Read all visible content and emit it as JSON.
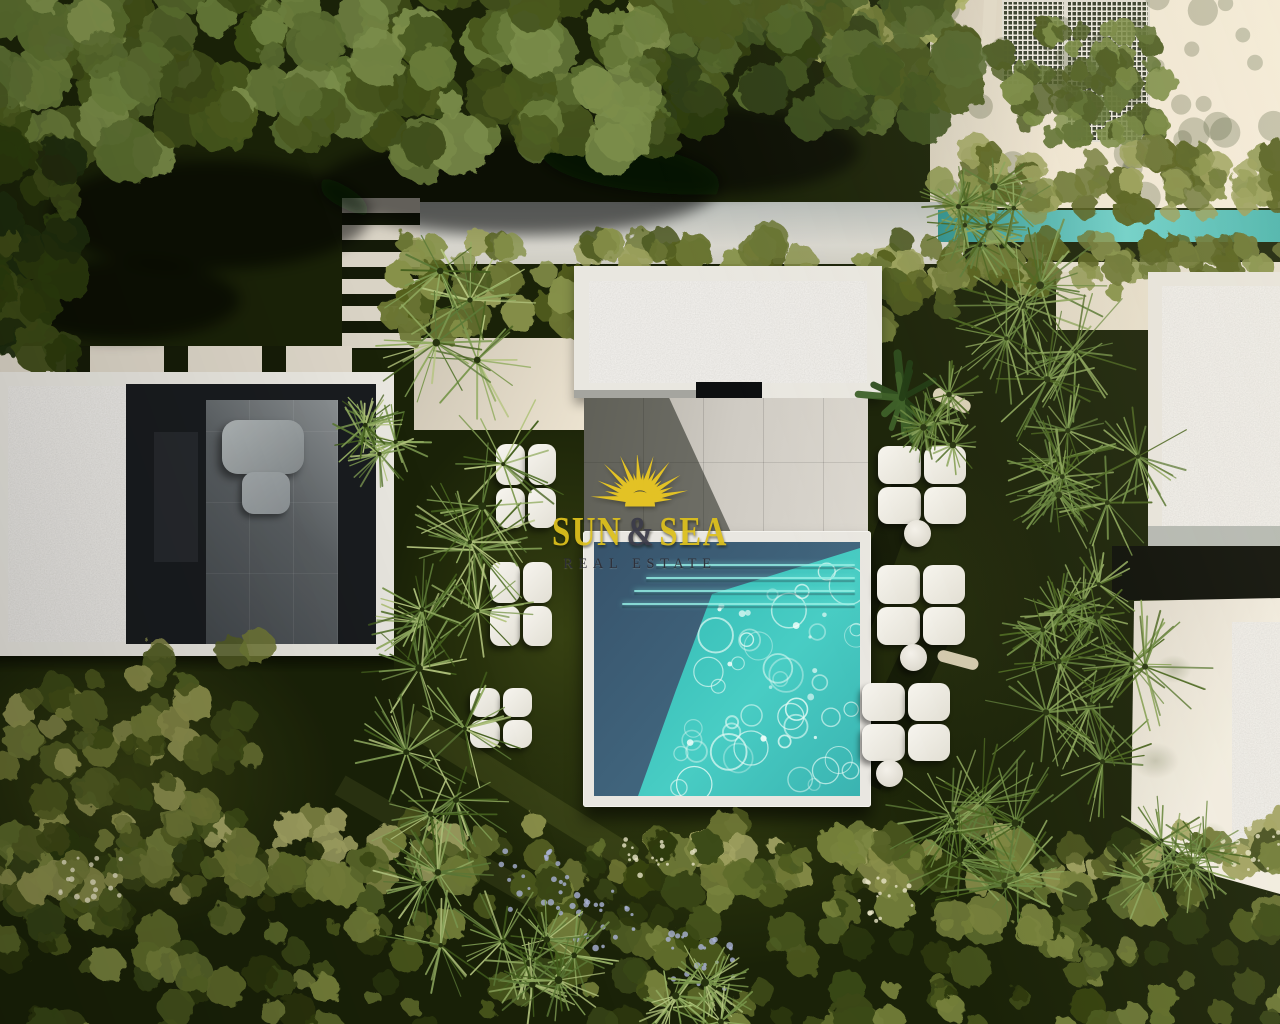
{
  "watermark": {
    "brand": {
      "word1": "SUN",
      "ampersand": "&",
      "word2": "SEA"
    },
    "tagline": "REAL ESTATE",
    "icon": "sun-icon",
    "colors": {
      "brand_text": "#dcbf1d",
      "ampersand": "#3c3c48",
      "tagline": "#2e2e36",
      "sun": "#eac822"
    }
  },
  "scene": {
    "palette": {
      "lawn_shadow": "#1a2208",
      "lawn_lit": "#4e5a1a",
      "canopy_green": "#5c6f33",
      "palm_green": "#7e9a52",
      "hedge_olive": "#87914a",
      "pool_turquoise": "#3ed2c6",
      "pool_shadow": "#3f617a",
      "paving_sunlit": "#ece3d0",
      "structure_white": "#e9e7e0",
      "gravel_gray": "#d3cfc6",
      "terrace_dark": "#43484c",
      "lap_pool_teal": "#58b9b2",
      "cushion_white": "#f3f1ea"
    }
  }
}
